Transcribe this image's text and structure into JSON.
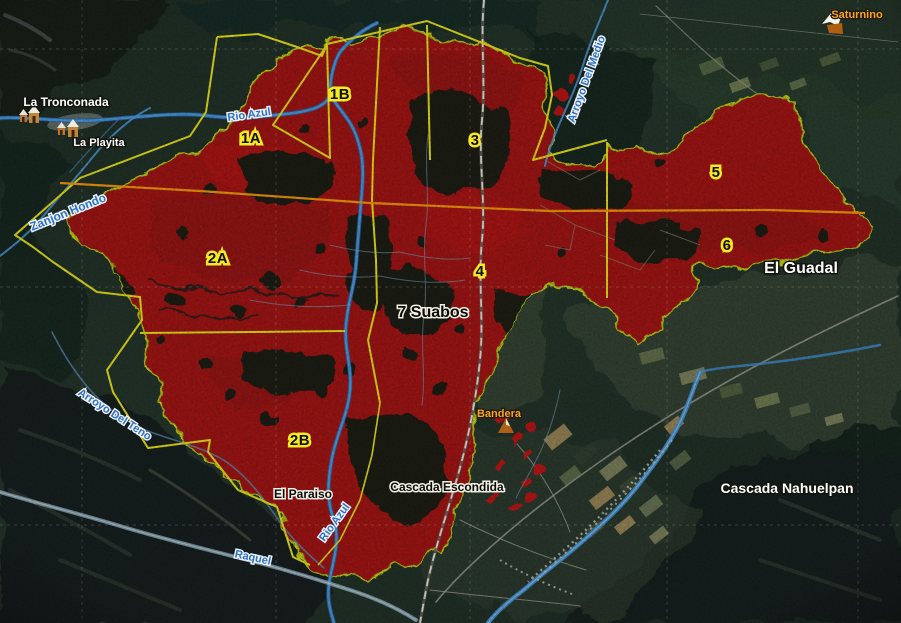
{
  "map": {
    "description": "Satellite fire-severity map with yellow sector boundaries over red burned area",
    "sectors": [
      {
        "id": "1A"
      },
      {
        "id": "1B"
      },
      {
        "id": "2A"
      },
      {
        "id": "2B"
      },
      {
        "id": "3"
      },
      {
        "id": "4"
      },
      {
        "id": "5"
      },
      {
        "id": "6"
      }
    ],
    "places": [
      {
        "name": "La Tronconada"
      },
      {
        "name": "La Playita"
      },
      {
        "name": "Saturnino"
      },
      {
        "name": "Bandera"
      },
      {
        "name": "El Guadal"
      },
      {
        "name": "Cascada Nahuelpan"
      },
      {
        "name": "El Paraiso"
      },
      {
        "name": "Cascada Escondida"
      },
      {
        "name": "7 Suabos"
      }
    ],
    "rivers": [
      {
        "name": "Rio Azul"
      },
      {
        "name": "Zanjon Hondo"
      },
      {
        "name": "Arroyo Del Medio"
      },
      {
        "name": "Arroyo Del Teno"
      },
      {
        "name": "Rio Azul"
      },
      {
        "name": "Raquel"
      }
    ],
    "colors": {
      "burn_area": "#d40c10",
      "burn_outline": "#dbe90f",
      "sector_boundary": "#f2ee12",
      "division_line": "#ff9d00",
      "river": "#4aa2ea",
      "river_label": "#2f6fc4",
      "zone_label_halo": "#f6e926",
      "poi_label": "#f2a62e"
    }
  }
}
